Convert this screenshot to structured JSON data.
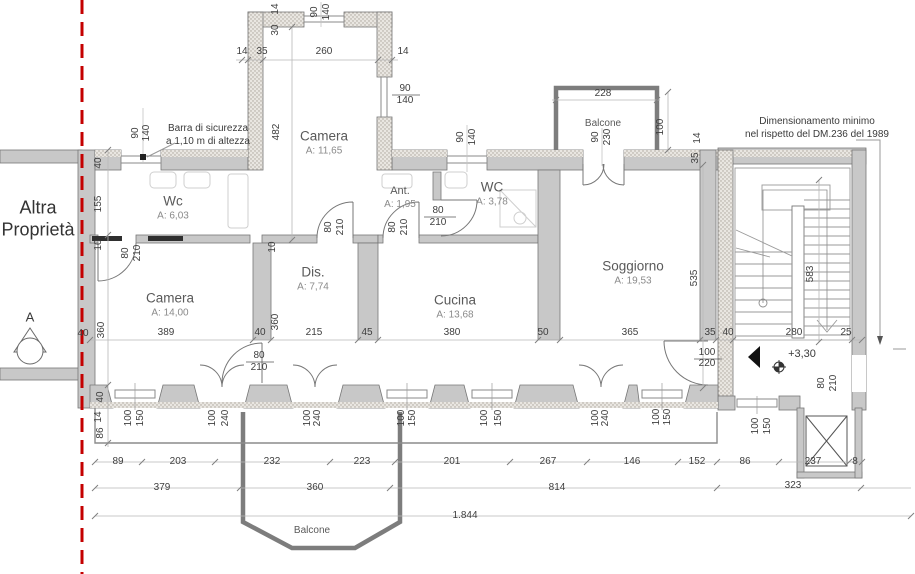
{
  "annotations": {
    "property": [
      "Altra",
      "Proprietà"
    ],
    "security_bar": [
      "Barra di sicurezza",
      "a 1,10 m di altezza"
    ],
    "dm_note": [
      "Dimensionamento minimo",
      "nel rispetto del DM.236 del 1989"
    ],
    "level": "+3,30",
    "section_marker": "A"
  },
  "rooms": [
    {
      "name": "Camera",
      "area": "A: 11,65",
      "x": 324,
      "y": 143,
      "fs": 13.5
    },
    {
      "name": "Wc",
      "area": "A: 6,03",
      "x": 173,
      "y": 208,
      "fs": 13.5
    },
    {
      "name": "Ant.",
      "area": "A: 1,95",
      "x": 400,
      "y": 198,
      "fs": 11
    },
    {
      "name": "WC",
      "area": "A: 3,78",
      "x": 492,
      "y": 194,
      "fs": 13.5
    },
    {
      "name": "Dis.",
      "area": "A: 7,74",
      "x": 313,
      "y": 279,
      "fs": 13.5
    },
    {
      "name": "Camera",
      "area": "A: 14,00",
      "x": 170,
      "y": 305,
      "fs": 13.5
    },
    {
      "name": "Cucina",
      "area": "A: 13,68",
      "x": 455,
      "y": 307,
      "fs": 13.5
    },
    {
      "name": "Soggiorno",
      "area": "A: 19,53",
      "x": 633,
      "y": 273,
      "fs": 13.5
    },
    {
      "name": "Balcone",
      "area": "",
      "x": 603,
      "y": 124,
      "fs": 10
    },
    {
      "name": "Balcone",
      "area": "",
      "x": 312,
      "y": 531,
      "fs": 10
    }
  ],
  "dims": [
    {
      "t": "90",
      "x": 315,
      "y": 12,
      "v": 1
    },
    {
      "t": "140",
      "x": 327,
      "y": 12,
      "v": 1
    },
    {
      "t": "14",
      "x": 276,
      "y": 9,
      "v": 1
    },
    {
      "t": "30",
      "x": 276,
      "y": 30,
      "v": 1
    },
    {
      "t": "14",
      "x": 242,
      "y": 52,
      "v": 0
    },
    {
      "t": "35",
      "x": 262,
      "y": 52,
      "v": 0
    },
    {
      "t": "260",
      "x": 324,
      "y": 52,
      "v": 0
    },
    {
      "t": "14",
      "x": 403,
      "y": 52,
      "v": 0
    },
    {
      "t": "90",
      "x": 405,
      "y": 89,
      "v": 0
    },
    {
      "t": "140",
      "x": 405,
      "y": 101,
      "v": 0
    },
    {
      "t": "482",
      "x": 277,
      "y": 132,
      "v": 1
    },
    {
      "t": "90",
      "x": 136,
      "y": 133,
      "v": 1
    },
    {
      "t": "140",
      "x": 147,
      "y": 133,
      "v": 1
    },
    {
      "t": "40",
      "x": 99,
      "y": 163,
      "v": 1
    },
    {
      "t": "155",
      "x": 99,
      "y": 204,
      "v": 1
    },
    {
      "t": "10",
      "x": 99,
      "y": 245,
      "v": 1
    },
    {
      "t": "80",
      "x": 126,
      "y": 253,
      "v": 1
    },
    {
      "t": "210",
      "x": 138,
      "y": 253,
      "v": 1
    },
    {
      "t": "360",
      "x": 102,
      "y": 330,
      "v": 1
    },
    {
      "t": "40",
      "x": 83,
      "y": 334,
      "v": 0
    },
    {
      "t": "90",
      "x": 461,
      "y": 137,
      "v": 1
    },
    {
      "t": "140",
      "x": 473,
      "y": 137,
      "v": 1
    },
    {
      "t": "10",
      "x": 273,
      "y": 247,
      "v": 1
    },
    {
      "t": "80",
      "x": 329,
      "y": 227,
      "v": 1
    },
    {
      "t": "210",
      "x": 341,
      "y": 227,
      "v": 1
    },
    {
      "t": "80",
      "x": 393,
      "y": 227,
      "v": 1
    },
    {
      "t": "210",
      "x": 405,
      "y": 227,
      "v": 1
    },
    {
      "t": "80",
      "x": 438,
      "y": 211,
      "v": 0
    },
    {
      "t": "210",
      "x": 438,
      "y": 223,
      "v": 0
    },
    {
      "t": "228",
      "x": 603,
      "y": 94,
      "v": 0
    },
    {
      "t": "90",
      "x": 596,
      "y": 137,
      "v": 1
    },
    {
      "t": "230",
      "x": 608,
      "y": 137,
      "v": 1
    },
    {
      "t": "100",
      "x": 661,
      "y": 127,
      "v": 1
    },
    {
      "t": "14",
      "x": 698,
      "y": 138,
      "v": 1
    },
    {
      "t": "35",
      "x": 696,
      "y": 158,
      "v": 1
    },
    {
      "t": "535",
      "x": 695,
      "y": 278,
      "v": 1
    },
    {
      "t": "583",
      "x": 811,
      "y": 274,
      "v": 1
    },
    {
      "t": "389",
      "x": 166,
      "y": 333,
      "v": 0
    },
    {
      "t": "40",
      "x": 260,
      "y": 333,
      "v": 0
    },
    {
      "t": "215",
      "x": 314,
      "y": 333,
      "v": 0
    },
    {
      "t": "45",
      "x": 367,
      "y": 333,
      "v": 0
    },
    {
      "t": "380",
      "x": 452,
      "y": 333,
      "v": 0
    },
    {
      "t": "50",
      "x": 543,
      "y": 333,
      "v": 0
    },
    {
      "t": "365",
      "x": 630,
      "y": 333,
      "v": 0
    },
    {
      "t": "35",
      "x": 710,
      "y": 333,
      "v": 0
    },
    {
      "t": "40",
      "x": 728,
      "y": 333,
      "v": 0
    },
    {
      "t": "280",
      "x": 794,
      "y": 333,
      "v": 0
    },
    {
      "t": "25",
      "x": 846,
      "y": 333,
      "v": 0
    },
    {
      "t": "360",
      "x": 276,
      "y": 322,
      "v": 1
    },
    {
      "t": "80",
      "x": 259,
      "y": 356,
      "v": 0
    },
    {
      "t": "210",
      "x": 259,
      "y": 368,
      "v": 0
    },
    {
      "t": "100",
      "x": 707,
      "y": 353,
      "v": 0
    },
    {
      "t": "220",
      "x": 707,
      "y": 364,
      "v": 0
    },
    {
      "t": "80",
      "x": 822,
      "y": 383,
      "v": 1
    },
    {
      "t": "210",
      "x": 834,
      "y": 383,
      "v": 1
    },
    {
      "t": "100",
      "x": 129,
      "y": 418,
      "v": 1
    },
    {
      "t": "150",
      "x": 141,
      "y": 418,
      "v": 1
    },
    {
      "t": "100",
      "x": 213,
      "y": 418,
      "v": 1
    },
    {
      "t": "240",
      "x": 226,
      "y": 418,
      "v": 1
    },
    {
      "t": "100",
      "x": 308,
      "y": 418,
      "v": 1
    },
    {
      "t": "240",
      "x": 318,
      "y": 418,
      "v": 1
    },
    {
      "t": "100",
      "x": 402,
      "y": 418,
      "v": 1
    },
    {
      "t": "150",
      "x": 413,
      "y": 418,
      "v": 1
    },
    {
      "t": "100",
      "x": 485,
      "y": 418,
      "v": 1
    },
    {
      "t": "150",
      "x": 499,
      "y": 418,
      "v": 1
    },
    {
      "t": "100",
      "x": 596,
      "y": 418,
      "v": 1
    },
    {
      "t": "240",
      "x": 606,
      "y": 418,
      "v": 1
    },
    {
      "t": "100",
      "x": 657,
      "y": 417,
      "v": 1
    },
    {
      "t": "150",
      "x": 668,
      "y": 417,
      "v": 1
    },
    {
      "t": "100",
      "x": 756,
      "y": 426,
      "v": 1
    },
    {
      "t": "150",
      "x": 768,
      "y": 426,
      "v": 1
    },
    {
      "t": "40",
      "x": 101,
      "y": 397,
      "v": 1
    },
    {
      "t": "14",
      "x": 99,
      "y": 417,
      "v": 1
    },
    {
      "t": "86",
      "x": 101,
      "y": 433,
      "v": 1
    },
    {
      "t": "89",
      "x": 118,
      "y": 462,
      "v": 0
    },
    {
      "t": "203",
      "x": 178,
      "y": 462,
      "v": 0
    },
    {
      "t": "232",
      "x": 272,
      "y": 462,
      "v": 0
    },
    {
      "t": "223",
      "x": 362,
      "y": 462,
      "v": 0
    },
    {
      "t": "201",
      "x": 452,
      "y": 462,
      "v": 0
    },
    {
      "t": "267",
      "x": 548,
      "y": 462,
      "v": 0
    },
    {
      "t": "146",
      "x": 632,
      "y": 462,
      "v": 0
    },
    {
      "t": "152",
      "x": 697,
      "y": 462,
      "v": 0
    },
    {
      "t": "86",
      "x": 745,
      "y": 462,
      "v": 0
    },
    {
      "t": "237",
      "x": 813,
      "y": 462,
      "v": 0
    },
    {
      "t": "8",
      "x": 855,
      "y": 462,
      "v": 0
    },
    {
      "t": "379",
      "x": 162,
      "y": 488,
      "v": 0
    },
    {
      "t": "360",
      "x": 315,
      "y": 488,
      "v": 0
    },
    {
      "t": "814",
      "x": 557,
      "y": 488,
      "v": 0
    },
    {
      "t": "323",
      "x": 793,
      "y": 486,
      "v": 0
    },
    {
      "t": "1.844",
      "x": 465,
      "y": 516,
      "v": 0
    }
  ]
}
